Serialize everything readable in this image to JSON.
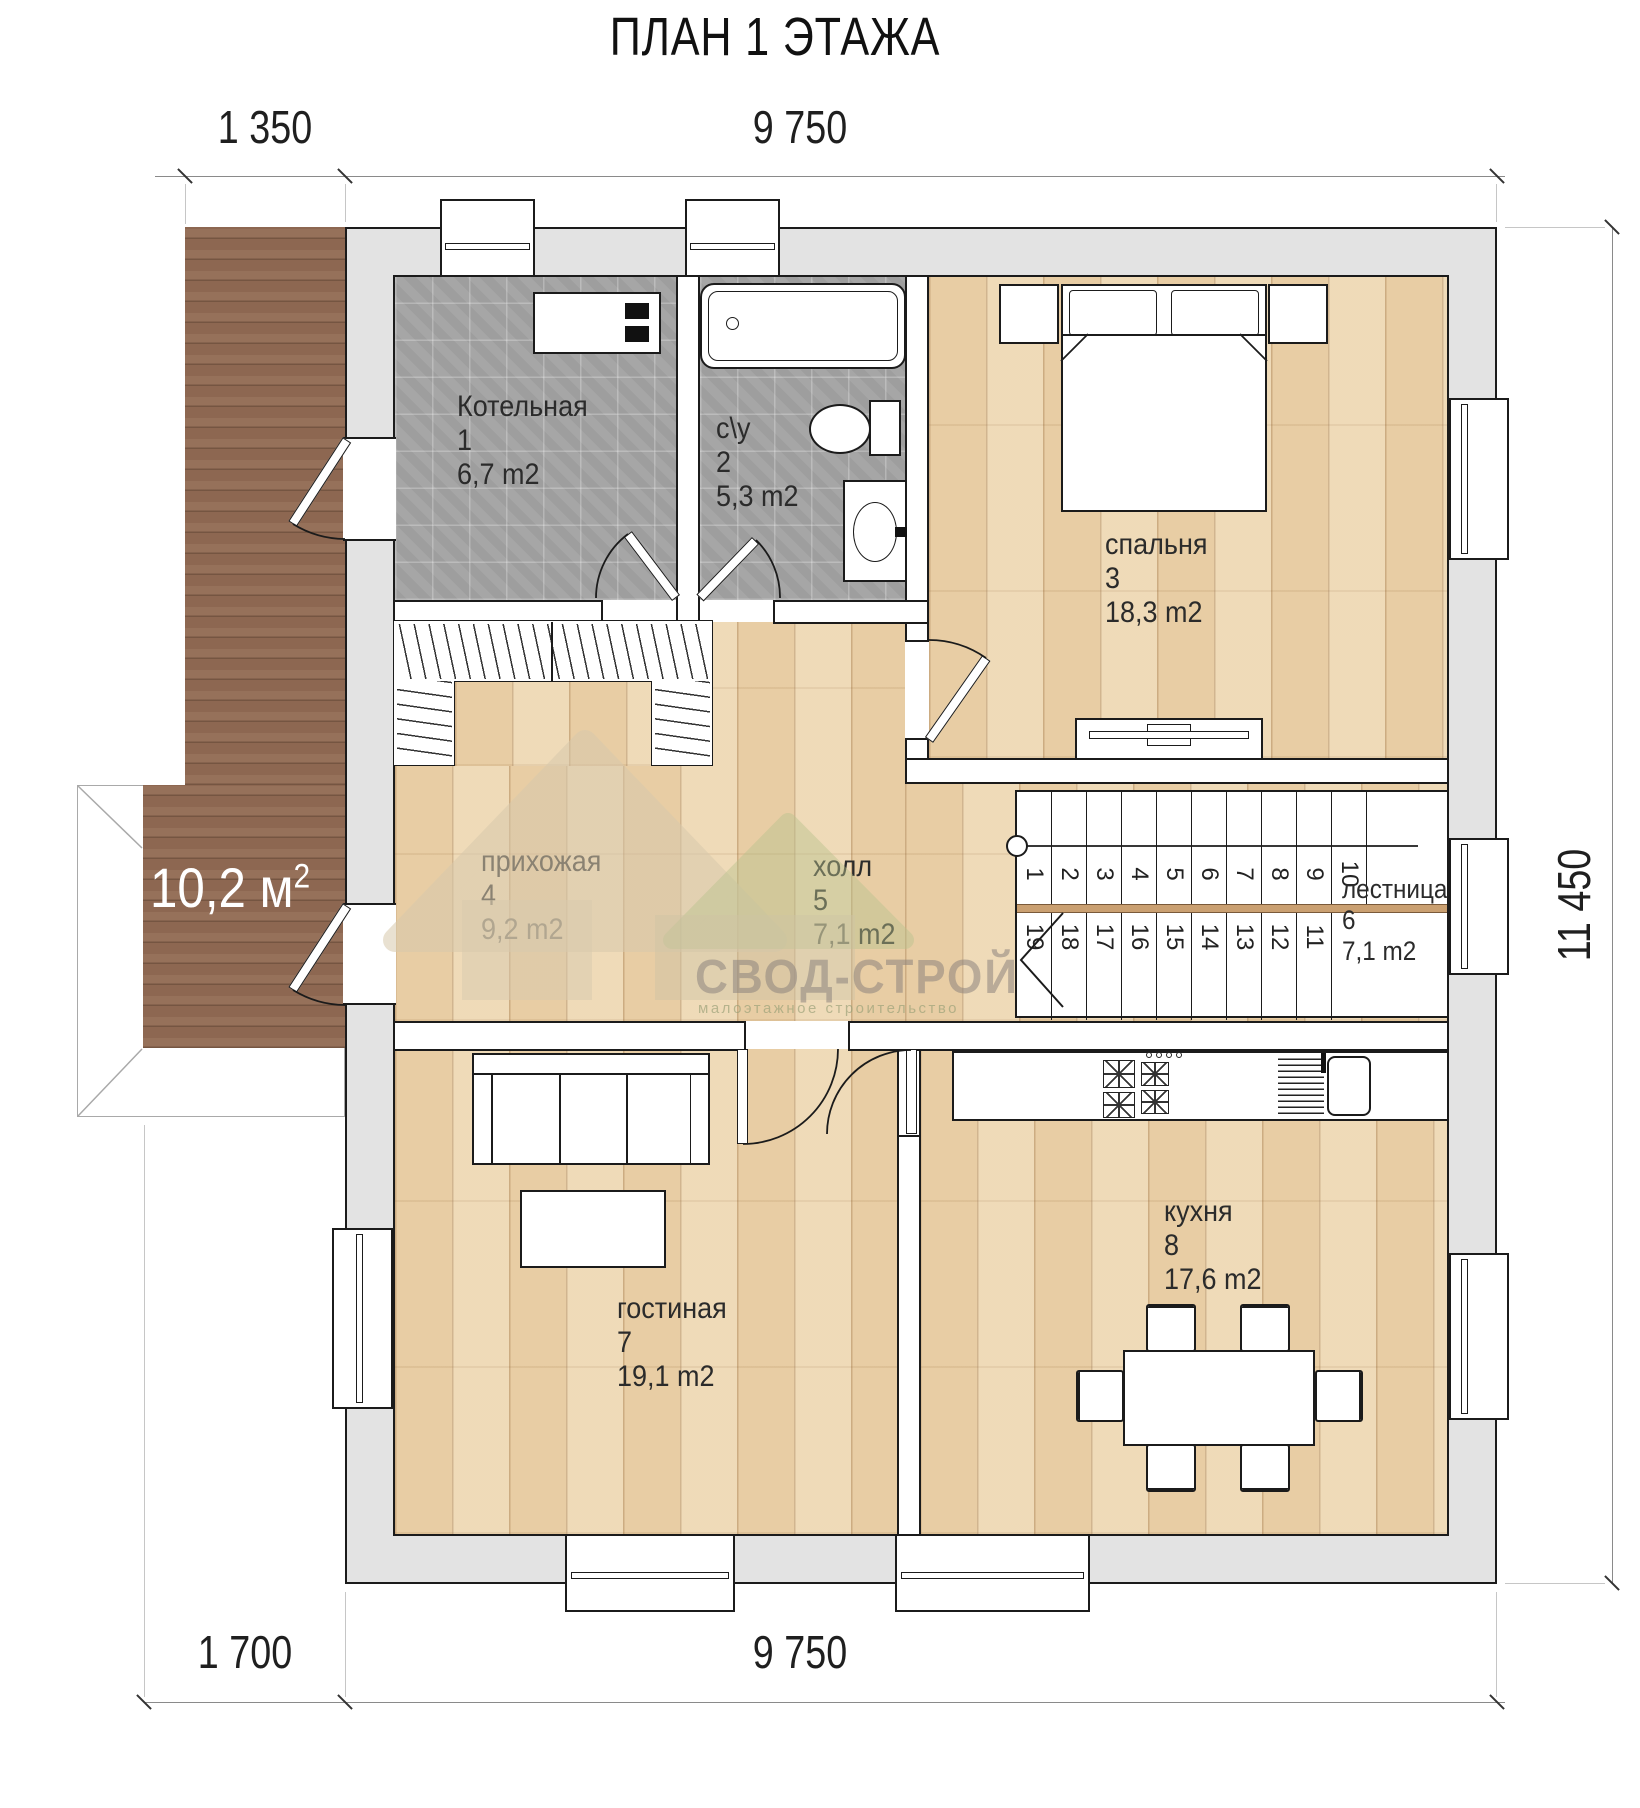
{
  "title": "ПЛАН 1 ЭТАЖА",
  "dimensions": {
    "top_left": "1 350",
    "top_main": "9 750",
    "bottom_left": "1 700",
    "bottom_main": "9 750",
    "right": "11 450"
  },
  "terrace": {
    "label": "10,2 м",
    "sup": "2"
  },
  "rooms": {
    "boiler": {
      "name": "Котельная",
      "num": "1",
      "area": "6,7 m2"
    },
    "wc": {
      "name": "с\\у",
      "num": "2",
      "area": "5,3 m2"
    },
    "bedroom": {
      "name": "спальня",
      "num": "3",
      "area": "18,3 m2"
    },
    "hallway": {
      "name": "прихожая",
      "num": "4",
      "area": "9,2 m2"
    },
    "hall": {
      "name": "холл",
      "num": "5",
      "area": "7,1 m2"
    },
    "stairs": {
      "name": "лестница",
      "num": "6",
      "area": "7,1 m2"
    },
    "living": {
      "name": "гостиная",
      "num": "7",
      "area": "19,1 m2"
    },
    "kitchen": {
      "name": "кухня",
      "num": "8",
      "area": "17,6 m2"
    }
  },
  "stairs": {
    "upper": [
      "1",
      "2",
      "3",
      "4",
      "5",
      "6",
      "7",
      "8",
      "9",
      "10"
    ],
    "lower": [
      "19",
      "18",
      "17",
      "16",
      "15",
      "14",
      "13",
      "12",
      "11"
    ]
  },
  "watermark": {
    "brand": "СВОД-СТРОЙ",
    "tagline": "малоэтажное строительство"
  },
  "colors": {
    "wall": "#e3e3e3",
    "outline": "#1b1b1b",
    "wood": "#ecd5ae",
    "tile": "#a6a6a6",
    "deck": "#8d6751"
  }
}
